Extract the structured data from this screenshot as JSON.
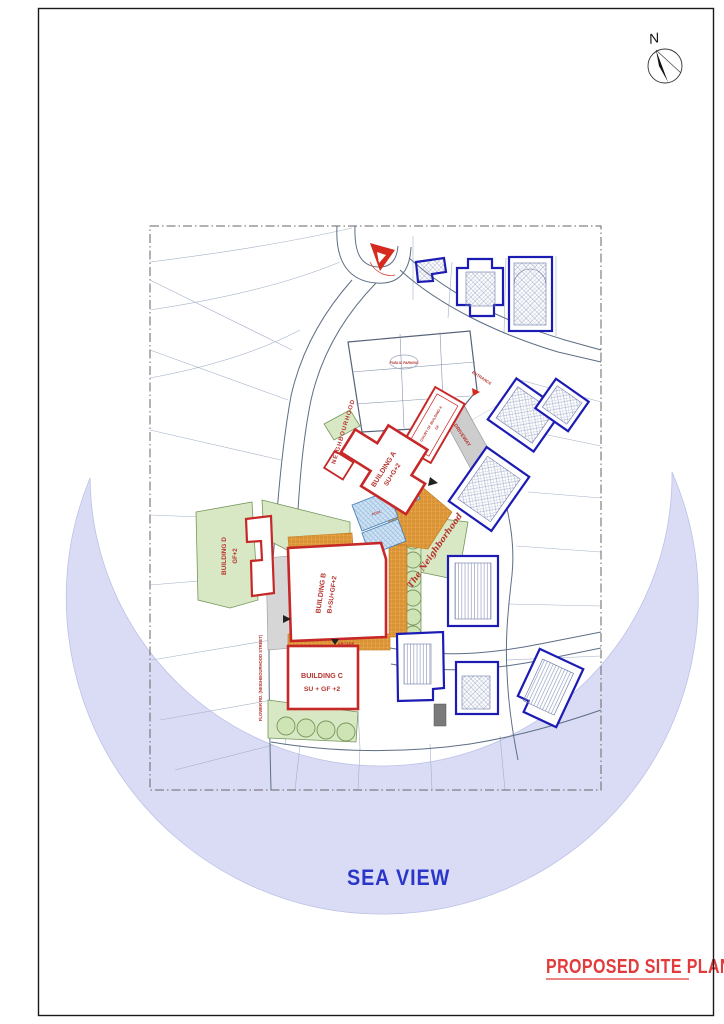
{
  "page": {
    "north_label": "N",
    "sea_view_label": "SEA VIEW",
    "title": "PROPOSED SITE PLAN"
  },
  "buildings": {
    "a": {
      "name": "BUILDING A",
      "floors": "SU+G+2"
    },
    "b": {
      "name": "BUILDING B",
      "floors": "B+SU+GF+2"
    },
    "c": {
      "name": "BUILDING C",
      "floors": "SU + GF +2"
    },
    "d": {
      "name": "BUILDING D",
      "floors": "GF+2"
    },
    "court_a": {
      "name": "COURT OF BUILDING A",
      "floors": "GF"
    }
  },
  "labels": {
    "neighbourhood_road": "NEIGHBOURHOOD",
    "flower_road": "FLOWER RD. (NEIGHBOURHOOD STREET)",
    "driveway": "DRIVEWAY",
    "entrance": "ENTRANCE",
    "arcade": "ARCADE",
    "public_parking": "PUBLIC PARKING",
    "park_name": "The Neighborhood",
    "pool": "POOL"
  },
  "colors": {
    "proposed_outline": "#c62828",
    "existing_outline": "#1c1cb5",
    "sea_fill": "#d9dcf4",
    "sea_text": "#2b36c9",
    "title_red": "#e23b3b",
    "green_fill": "#d8e8c4",
    "plaza_orange": "#eda84a",
    "label_red": "#b5342e"
  }
}
